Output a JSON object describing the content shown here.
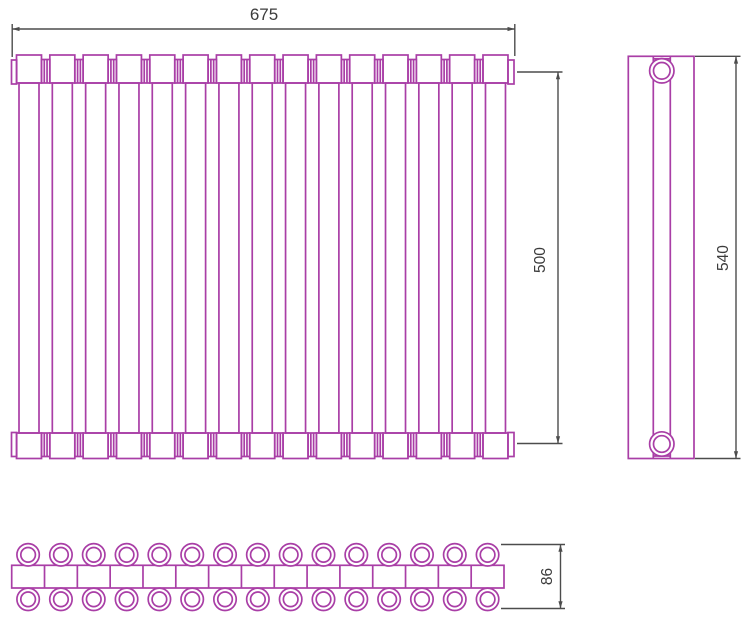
{
  "drawing": {
    "colors": {
      "outline": "#a93ea6",
      "dimension_lines": "#4c4c4c",
      "text": "#3c3c3c",
      "background": "#ffffff"
    },
    "dimensions": {
      "width": {
        "value": "675",
        "orientation": "horizontal",
        "applies_to": "front-view overall width"
      },
      "connection_height": {
        "value": "500",
        "orientation": "vertical",
        "applies_to": "front-view connection axis spacing"
      },
      "overall_height": {
        "value": "540",
        "orientation": "vertical",
        "applies_to": "side-view overall height"
      },
      "depth": {
        "value": "86",
        "orientation": "vertical",
        "applies_to": "bottom-view overall depth"
      }
    },
    "front_view": {
      "tube_count": 15,
      "connector_count": 14
    },
    "side_view": {
      "collector_count": 2
    },
    "bottom_view": {
      "section_count": 15,
      "rows": 2,
      "circles_per_row": 15
    }
  }
}
